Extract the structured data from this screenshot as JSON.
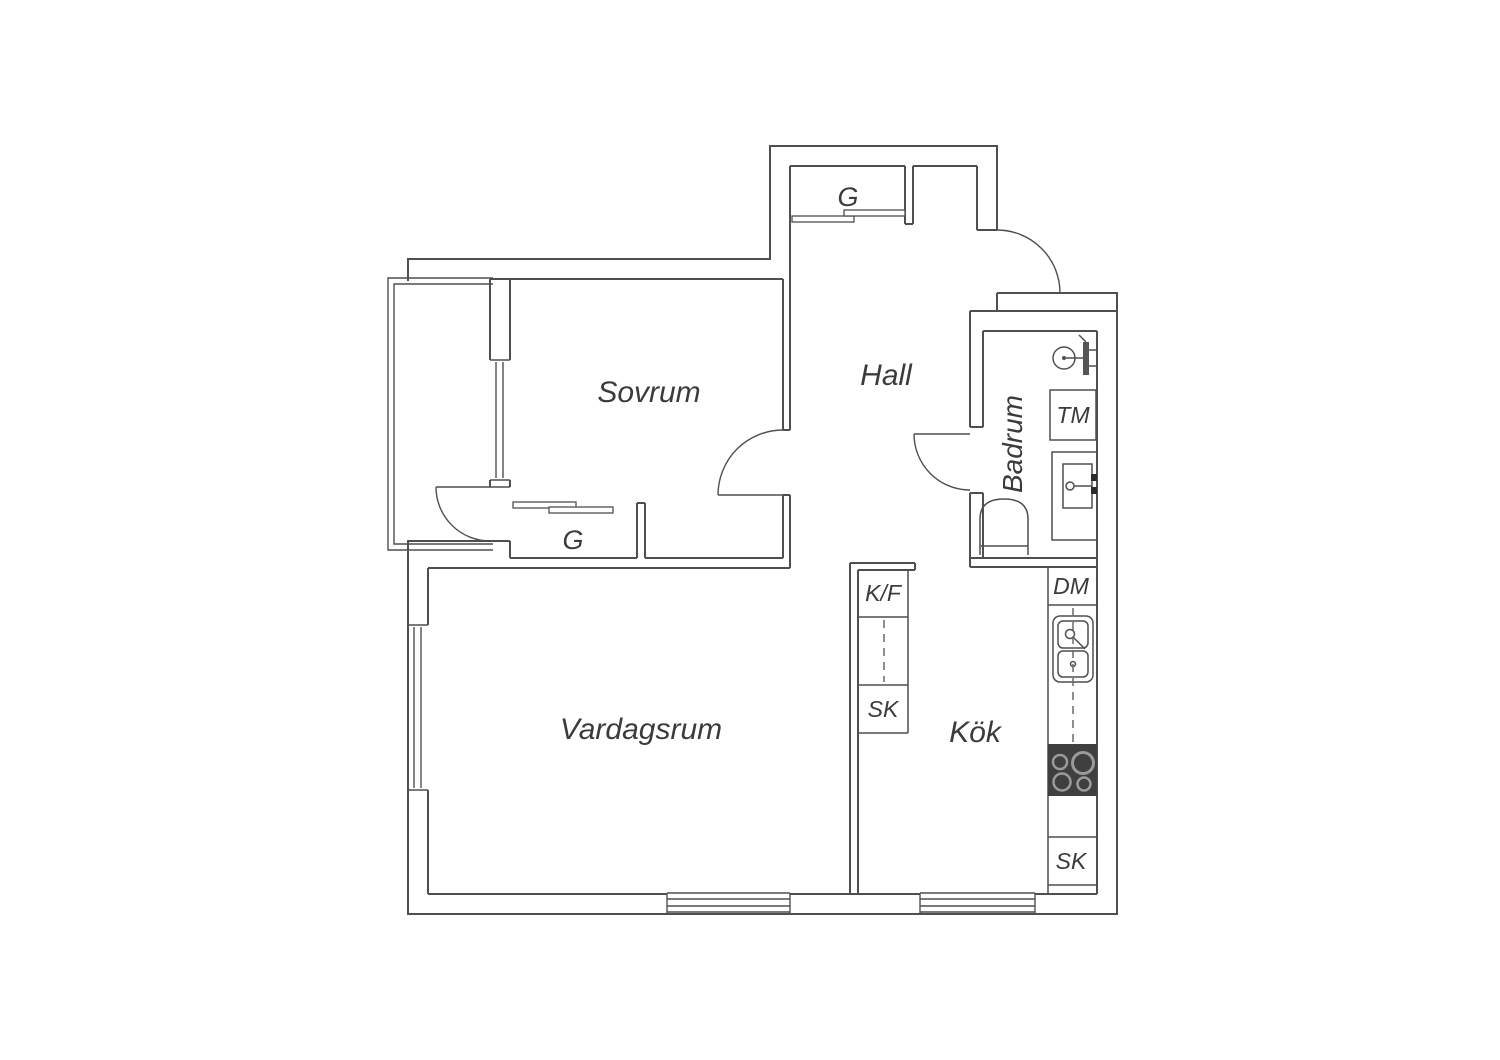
{
  "plan": {
    "title": "apartment-floor-plan",
    "background_color": "#ffffff",
    "line_color": "#4f4f4f",
    "text_color": "#3b3b3b",
    "stove_color": "#3f3f3f",
    "labels": {
      "sovrum": "Sovrum",
      "hall": "Hall",
      "badrum": "Badrum",
      "vardagsrum": "Vardagsrum",
      "kok": "Kök",
      "closet_top": "G",
      "closet_sovrum": "G",
      "tm": "TM",
      "dm": "DM",
      "kf": "K/F",
      "sk_left": "SK",
      "sk_right": "SK"
    },
    "fixtures": [
      "shower-icon",
      "toilet-icon",
      "bathroom-sink-icon",
      "kitchen-sink-icon",
      "stove-icon",
      "washing-machine-box",
      "dishwasher-box",
      "fridge-freezer-box",
      "cabinet-box",
      "window-symbol",
      "door-arc-symbol",
      "sliding-door-symbol",
      "balcony-outline"
    ]
  }
}
